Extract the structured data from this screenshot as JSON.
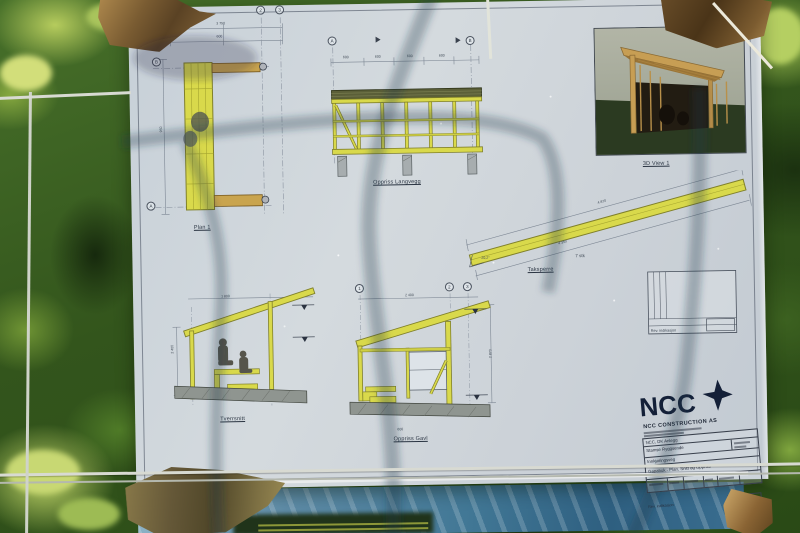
{
  "sheet": {
    "labels": {
      "plan": "Plan 1",
      "long_wall_elevation": "Oppriss Langvegg",
      "view_3d": "3D View 1",
      "rafter": "Taksperre",
      "rafter_count": "7 stk",
      "rafter_angle": "20,2°",
      "cross_section": "Tverrsnitt",
      "gable_elevation": "Oppriss Gavl"
    },
    "grid_bubbles": {
      "plan": [
        "2",
        "3",
        "B",
        "A"
      ],
      "long_wall": [
        "A",
        "B"
      ],
      "gable": [
        "1",
        "2",
        "3"
      ]
    },
    "dims": {
      "plan": [
        "3 750",
        "950",
        "600"
      ],
      "long_wall": [
        "600",
        "600",
        "600",
        "600"
      ],
      "rafter": [
        "4 870",
        "4 350"
      ],
      "cross_section": [
        "2 400",
        "1 800"
      ],
      "gable": [
        "2 870",
        "2 400",
        "600"
      ]
    },
    "title_block": {
      "logo_text": "NCC",
      "company": "NCC CONSTRUCTION AS",
      "rows": {
        "client": "NCC, DK Anlegg",
        "project": "Stamse Ryggsende",
        "road": "Innkjøringsveg",
        "drawing_title": "Gapahuk - Plan, Snitt og Oppriss"
      },
      "rev_note": "Rev. indikasjon"
    },
    "colors": {
      "highlight_yellow": "#d9d94b",
      "ncc_navy": "#142038",
      "tarp_blue": "#3f7394",
      "paper": "#ccd3da"
    }
  }
}
